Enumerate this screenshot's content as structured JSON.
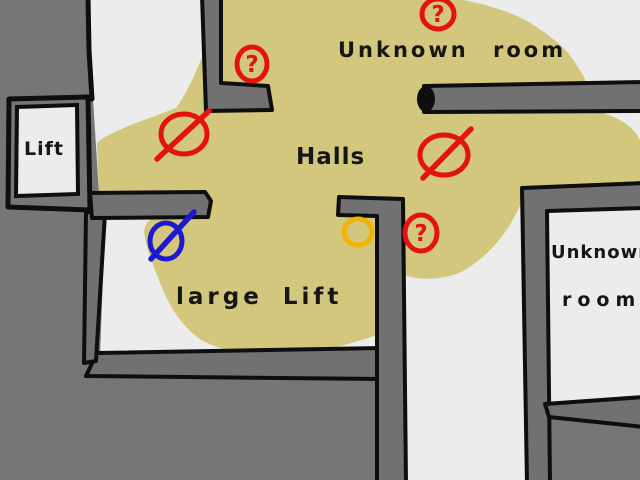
{
  "map": {
    "labels": {
      "unknown_room_top": "Unknown room",
      "halls": "Halls",
      "lift": "Lift",
      "large_lift": "large Lift",
      "unknown_room_right_line1": "Unknown",
      "unknown_room_right_line2": "room"
    },
    "colors": {
      "background": "#767676",
      "floor": "#ececec",
      "explored_area": "#d2c77c",
      "outline": "#0e0e0e",
      "marker_red": "#e41310",
      "marker_blue": "#1b1ace",
      "marker_yellow": "#f0b402"
    },
    "markers": [
      {
        "icon": "question-mark-icon",
        "glyph": "?",
        "color": "#e41310",
        "cx": 252,
        "cy": 64,
        "rx": 15,
        "ry": 17
      },
      {
        "icon": "question-mark-icon",
        "glyph": "?",
        "color": "#e41310",
        "cx": 438,
        "cy": 14,
        "rx": 16,
        "ry": 15
      },
      {
        "icon": "question-mark-icon",
        "glyph": "?",
        "color": "#e41310",
        "cx": 421,
        "cy": 233,
        "rx": 16,
        "ry": 18
      },
      {
        "icon": "no-entry-icon",
        "color": "#e41310",
        "cx": 184,
        "cy": 134,
        "rx": 23,
        "ry": 20,
        "slash": {
          "x1": 157,
          "y1": 159,
          "x2": 209,
          "y2": 111
        }
      },
      {
        "icon": "no-entry-icon",
        "color": "#e41310",
        "cx": 444,
        "cy": 155,
        "rx": 24,
        "ry": 20,
        "slash": {
          "x1": 423,
          "y1": 178,
          "x2": 471,
          "y2": 129
        }
      },
      {
        "icon": "no-entry-icon",
        "color": "#1b1ace",
        "cx": 166,
        "cy": 241,
        "rx": 16,
        "ry": 18,
        "slash": {
          "x1": 151,
          "y1": 259,
          "x2": 194,
          "y2": 212
        }
      },
      {
        "icon": "circle-marker-icon",
        "color": "#f0b402",
        "cx": 358,
        "cy": 232,
        "rx": 14,
        "ry": 13
      }
    ]
  }
}
